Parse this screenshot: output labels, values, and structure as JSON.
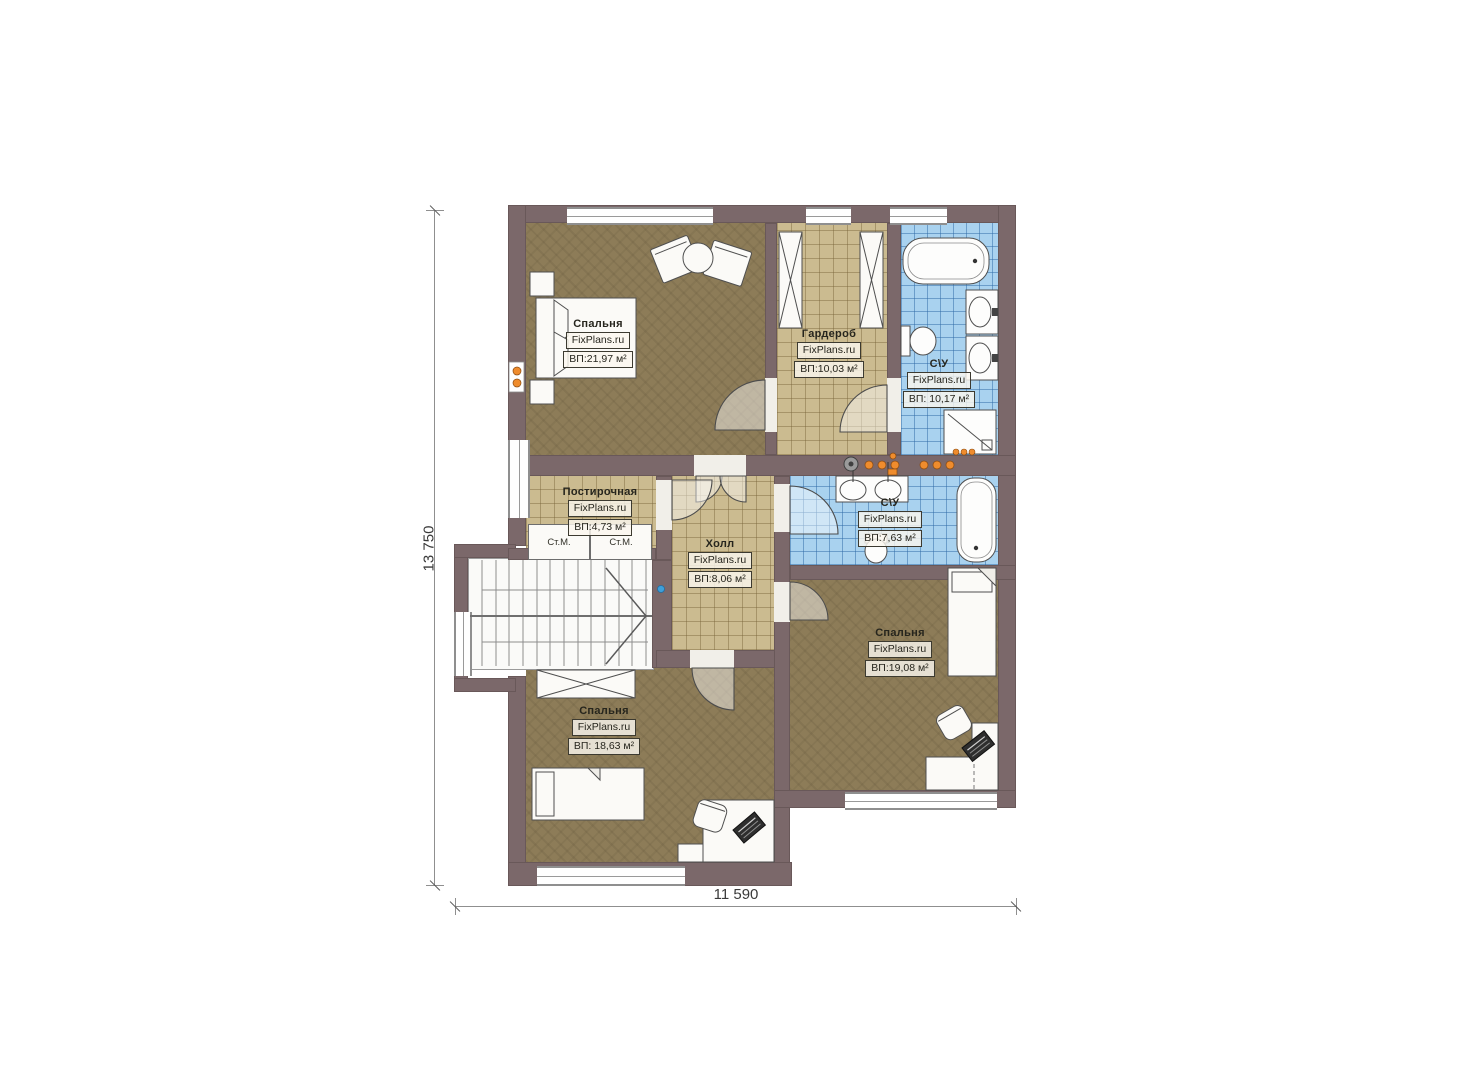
{
  "dimensions": {
    "height_label": "13 750",
    "width_label": "11 590"
  },
  "rooms": {
    "bedroom_top": {
      "name": "Спальня",
      "brand": "FixPlans.ru",
      "area": "ВП:21,97 м²"
    },
    "wardrobe": {
      "name": "Гардероб",
      "brand": "FixPlans.ru",
      "area": "ВП:10,03 м²"
    },
    "bath_top": {
      "name": "С\\У",
      "brand": "FixPlans.ru",
      "area": "ВП: 10,17 м²"
    },
    "laundry": {
      "name": "Постирочная",
      "brand": "FixPlans.ru",
      "area": "ВП:4,73 м²"
    },
    "hall": {
      "name": "Холл",
      "brand": "FixPlans.ru",
      "area": "ВП:8,06 м²"
    },
    "bath_mid": {
      "name": "С\\У",
      "brand": "FixPlans.ru",
      "area": "ВП:7,63 м²"
    },
    "bedroom_right": {
      "name": "Спальня",
      "brand": "FixPlans.ru",
      "area": "ВП:19,08 м²"
    },
    "bedroom_bottom": {
      "name": "Спальня",
      "brand": "FixPlans.ru",
      "area": "ВП: 18,63 м²"
    }
  },
  "appliances": {
    "washer_left": "Ст.М.",
    "washer_right": "Ст.М."
  },
  "colors": {
    "wall": "#7b686a",
    "bedroom_floor": "#8d7c58",
    "tile_floor": "#cbbb90",
    "bath_floor": "#a9d2ef",
    "accent_light": "#ef8c2d"
  }
}
